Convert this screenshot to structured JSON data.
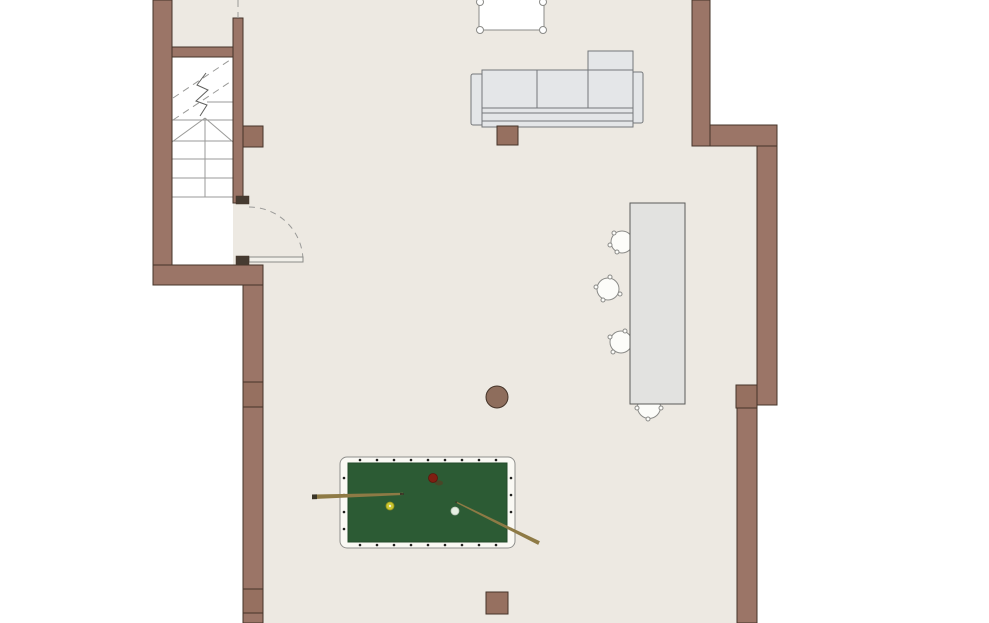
{
  "meta": {
    "title": "Floor plan — recreation level with staircase, lounge, dining area and billiard table",
    "type": "architectural-floor-plan"
  },
  "scene": {
    "rooms": [
      {
        "id": "stairwell",
        "label": "staircase enclosure with up-direction arrow and break line"
      },
      {
        "id": "main-room",
        "label": "open recreation room"
      }
    ],
    "furniture": [
      {
        "id": "top-table",
        "label": "table with corner legs, cut off at top edge"
      },
      {
        "id": "sofa",
        "label": "three-seat sofa with right chaise section"
      },
      {
        "id": "dining-table",
        "label": "rectangular dining table"
      },
      {
        "id": "dining-chairs",
        "label": "four round chairs",
        "count": 4
      },
      {
        "id": "billiard-table",
        "label": "billiard table with red, yellow and cue ball"
      },
      {
        "id": "cue-sticks",
        "label": "two cue sticks",
        "count": 2
      },
      {
        "id": "columns",
        "label": "structural columns (square and round)",
        "count": 4
      }
    ],
    "door": {
      "id": "entry-door",
      "label": "door at stair landing swinging into main room"
    }
  },
  "colors": {
    "floor": "#EDE9E2",
    "stairwell": "#FFFFFF",
    "wall": "#9B7567",
    "wallStroke": "#453429",
    "columnFill": "#967060",
    "hinge": "#463B31",
    "stairLine": "#9A9A98",
    "stairBreak": "#5F5F5D",
    "doorLeaf": "#F2F0EA",
    "sofaFill": "#E4E6E8",
    "sofaStroke": "#74777A",
    "tableFill": "#E2E2E0",
    "tableStroke": "#5B5B59",
    "chairFill": "#FCFCF9",
    "chairStroke": "#8B8B88",
    "poolFrame": "#FAF9F4",
    "poolFrameStroke": "#8F8F8C",
    "poolFelt": "#2C5B34",
    "poolFeltStroke": "#234A2A",
    "sightDot": "#1E1E1C",
    "ballRed": "#7E1F12",
    "ballYellow": "#C9C52F",
    "ballWhite": "#E6EFE3",
    "cue": "#8E7A45",
    "cueDark": "#3A3527",
    "roundColumn": "#8E6D5C"
  }
}
